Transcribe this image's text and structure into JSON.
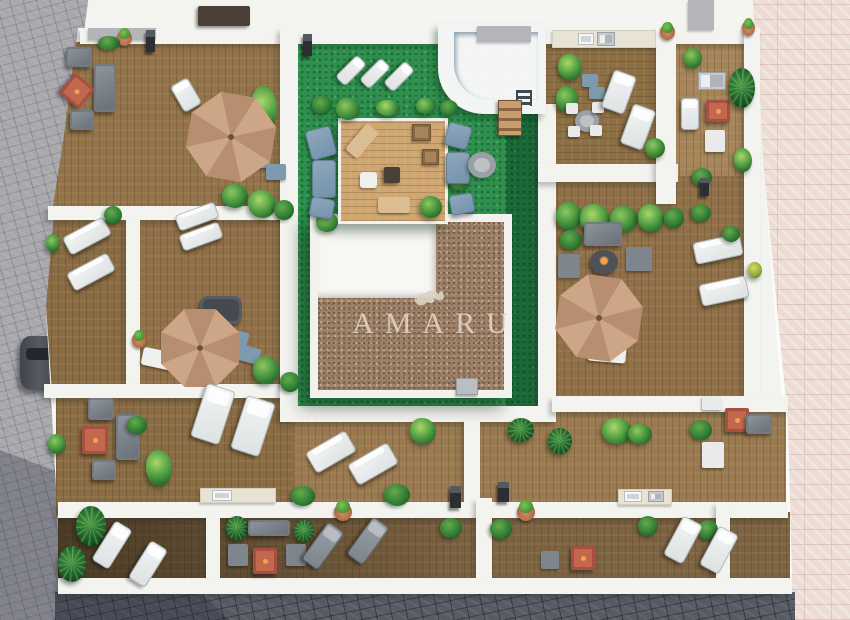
{
  "watermark": {
    "logo_icon": "amaru-monkey-logo-icon",
    "text": "AMARU"
  },
  "palette": {
    "street_white": "#f4f3f0",
    "wall_white": "#f3f3f0",
    "pavement_gray": "#a8a8ad",
    "pavement_dark": "#575b63",
    "pavement_pink": "#ecdcd4",
    "lawn_green": "#2e8f4e",
    "gravel_brown": "#9d8169",
    "pool_blue": "#7fc3e4",
    "umbrella_tan": "#c79f80",
    "fire_table_red": "#a8503f",
    "watermark_cream": "#ddd2c2"
  },
  "scene": {
    "items": [
      {
        "t": "car",
        "x": 20,
        "y": 336,
        "w": 42,
        "h": 54,
        "l": "under"
      },
      {
        "t": "table-dark",
        "x": 198,
        "y": 6,
        "w": 52,
        "h": 20
      },
      {
        "t": "gray-wall",
        "x": 88,
        "y": 28,
        "w": 68,
        "h": 12
      },
      {
        "t": "gray-wall",
        "x": 477,
        "y": 26,
        "w": 54,
        "h": 16
      },
      {
        "t": "gray-wall",
        "x": 688,
        "y": 0,
        "w": 26,
        "h": 30
      },
      {
        "t": "lamp",
        "x": 146,
        "y": 30,
        "w": 9,
        "h": 22
      },
      {
        "t": "lamp",
        "x": 303,
        "y": 34,
        "w": 9,
        "h": 22
      },
      {
        "t": "pot",
        "x": 117,
        "y": 30,
        "w": 15,
        "h": 16
      },
      {
        "t": "bush",
        "x": 98,
        "y": 36,
        "w": 22,
        "h": 14
      },
      {
        "t": "sofa-gray",
        "x": 66,
        "y": 47,
        "w": 26,
        "h": 20
      },
      {
        "t": "sofa-gray",
        "x": 94,
        "y": 64,
        "w": 22,
        "h": 48
      },
      {
        "t": "sofa-gray",
        "x": 70,
        "y": 110,
        "w": 24,
        "h": 20
      },
      {
        "t": "table-red",
        "x": 64,
        "y": 78,
        "w": 26,
        "h": 26,
        "r": 40
      },
      {
        "t": "lounger-white",
        "x": 176,
        "y": 80,
        "w": 20,
        "h": 30,
        "r": -30
      },
      {
        "t": "plant",
        "x": 251,
        "y": 86,
        "w": 26,
        "h": 44,
        "v": "leafy"
      },
      {
        "t": "chair-blue",
        "x": 250,
        "y": 152,
        "w": 20,
        "h": 16
      },
      {
        "t": "chair-blue",
        "x": 266,
        "y": 164,
        "w": 20,
        "h": 16
      },
      {
        "t": "umbrella",
        "x": 188,
        "y": 94,
        "w": 86,
        "h": 86,
        "r": 10
      },
      {
        "t": "lounger-white",
        "x": 344,
        "y": 55,
        "w": 14,
        "h": 31,
        "r": 45
      },
      {
        "t": "lounger-white",
        "x": 368,
        "y": 58,
        "w": 14,
        "h": 31,
        "r": 45
      },
      {
        "t": "lounger-white",
        "x": 392,
        "y": 61,
        "w": 14,
        "h": 31,
        "r": 45
      },
      {
        "t": "bush",
        "x": 312,
        "y": 96,
        "w": 20,
        "h": 18
      },
      {
        "t": "plant",
        "x": 336,
        "y": 98,
        "w": 24,
        "h": 22
      },
      {
        "t": "plant",
        "x": 376,
        "y": 100,
        "w": 24,
        "h": 16,
        "v": "leafy"
      },
      {
        "t": "plant",
        "x": 416,
        "y": 98,
        "w": 20,
        "h": 16
      },
      {
        "t": "bush",
        "x": 440,
        "y": 100,
        "w": 18,
        "h": 16
      },
      {
        "t": "plant",
        "x": 448,
        "y": 170,
        "w": 22,
        "h": 20,
        "v": "leafy"
      },
      {
        "t": "plant",
        "x": 316,
        "y": 212,
        "w": 22,
        "h": 20
      },
      {
        "t": "plant",
        "x": 420,
        "y": 196,
        "w": 22,
        "h": 22
      },
      {
        "t": "lounger-blue",
        "x": 308,
        "y": 128,
        "w": 26,
        "h": 30,
        "r": -15
      },
      {
        "t": "lounger-blue",
        "x": 312,
        "y": 160,
        "w": 24,
        "h": 38
      },
      {
        "t": "lounger-blue",
        "x": 310,
        "y": 198,
        "w": 24,
        "h": 20,
        "r": 10
      },
      {
        "t": "lounger-blue",
        "x": 446,
        "y": 124,
        "w": 24,
        "h": 24,
        "r": 15
      },
      {
        "t": "lounger-blue",
        "x": 446,
        "y": 152,
        "w": 24,
        "h": 32
      },
      {
        "t": "lounger-blue",
        "x": 450,
        "y": 194,
        "w": 24,
        "h": 20,
        "r": -10
      },
      {
        "t": "table-round-gray",
        "x": 468,
        "y": 152,
        "w": 28,
        "h": 26
      },
      {
        "t": "mat-tan",
        "x": 354,
        "y": 124,
        "w": 16,
        "h": 34,
        "r": 40
      },
      {
        "t": "table-wood",
        "x": 412,
        "y": 124,
        "w": 19,
        "h": 17
      },
      {
        "t": "table-wood",
        "x": 422,
        "y": 149,
        "w": 17,
        "h": 16
      },
      {
        "t": "table-dark",
        "x": 384,
        "y": 167,
        "w": 16,
        "h": 16
      },
      {
        "t": "mat-white",
        "x": 360,
        "y": 172,
        "w": 17,
        "h": 16
      },
      {
        "t": "mat-tan",
        "x": 378,
        "y": 197,
        "w": 32,
        "h": 16
      },
      {
        "t": "stairs",
        "x": 498,
        "y": 100,
        "w": 24,
        "h": 36
      },
      {
        "t": "counter",
        "x": 552,
        "y": 30,
        "w": 104,
        "h": 18
      },
      {
        "t": "sink",
        "x": 578,
        "y": 33,
        "w": 16,
        "h": 12
      },
      {
        "t": "appliance",
        "x": 597,
        "y": 32,
        "w": 18,
        "h": 14
      },
      {
        "t": "plant",
        "x": 558,
        "y": 54,
        "w": 24,
        "h": 26,
        "v": "leafy"
      },
      {
        "t": "plant",
        "x": 556,
        "y": 86,
        "w": 22,
        "h": 26
      },
      {
        "t": "chair-blue",
        "x": 582,
        "y": 74,
        "w": 16,
        "h": 13
      },
      {
        "t": "chair-blue",
        "x": 589,
        "y": 87,
        "w": 16,
        "h": 12
      },
      {
        "t": "table-round-gray",
        "x": 575,
        "y": 110,
        "w": 24,
        "h": 22
      },
      {
        "t": "chair-white",
        "x": 566,
        "y": 103,
        "w": 12,
        "h": 11
      },
      {
        "t": "chair-white",
        "x": 592,
        "y": 102,
        "w": 12,
        "h": 11
      },
      {
        "t": "chair-white",
        "x": 568,
        "y": 126,
        "w": 12,
        "h": 11
      },
      {
        "t": "chair-white",
        "x": 590,
        "y": 125,
        "w": 12,
        "h": 11
      },
      {
        "t": "lounger-white",
        "x": 607,
        "y": 72,
        "w": 24,
        "h": 40,
        "r": 20
      },
      {
        "t": "lounger-white",
        "x": 626,
        "y": 106,
        "w": 24,
        "h": 42,
        "r": 20
      },
      {
        "t": "plant",
        "x": 645,
        "y": 138,
        "w": 20,
        "h": 20
      },
      {
        "t": "pot",
        "x": 660,
        "y": 24,
        "w": 15,
        "h": 16
      },
      {
        "t": "appliance",
        "x": 698,
        "y": 72,
        "w": 28,
        "h": 18
      },
      {
        "t": "table-red",
        "x": 706,
        "y": 100,
        "w": 24,
        "h": 22
      },
      {
        "t": "chair-white",
        "x": 705,
        "y": 130,
        "w": 20,
        "h": 22
      },
      {
        "t": "lounger-white",
        "x": 681,
        "y": 98,
        "w": 18,
        "h": 32
      },
      {
        "t": "plant",
        "x": 684,
        "y": 48,
        "w": 18,
        "h": 20
      },
      {
        "t": "palm",
        "x": 729,
        "y": 68,
        "w": 26,
        "h": 40
      },
      {
        "t": "bush",
        "x": 692,
        "y": 168,
        "w": 20,
        "h": 18
      },
      {
        "t": "plant",
        "x": 734,
        "y": 148,
        "w": 18,
        "h": 24,
        "v": "leafy"
      },
      {
        "t": "pot",
        "x": 742,
        "y": 20,
        "w": 13,
        "h": 16
      },
      {
        "t": "lamp",
        "x": 700,
        "y": 178,
        "w": 9,
        "h": 18
      },
      {
        "t": "plant",
        "x": 556,
        "y": 202,
        "w": 26,
        "h": 28
      },
      {
        "t": "plant",
        "x": 580,
        "y": 204,
        "w": 30,
        "h": 30,
        "v": "leafy"
      },
      {
        "t": "plant",
        "x": 610,
        "y": 206,
        "w": 28,
        "h": 26
      },
      {
        "t": "plant",
        "x": 638,
        "y": 204,
        "w": 26,
        "h": 28,
        "v": "leafy"
      },
      {
        "t": "bush",
        "x": 560,
        "y": 230,
        "w": 22,
        "h": 20
      },
      {
        "t": "bush",
        "x": 664,
        "y": 208,
        "w": 20,
        "h": 20
      },
      {
        "t": "bush",
        "x": 691,
        "y": 204,
        "w": 20,
        "h": 18
      },
      {
        "t": "sofa-gray",
        "x": 584,
        "y": 222,
        "w": 38,
        "h": 24
      },
      {
        "t": "firepit-dark",
        "x": 590,
        "y": 250,
        "w": 28,
        "h": 24
      },
      {
        "t": "chair-gray",
        "x": 558,
        "y": 254,
        "w": 22,
        "h": 24
      },
      {
        "t": "chair-gray",
        "x": 626,
        "y": 247,
        "w": 26,
        "h": 24
      },
      {
        "t": "mat-white",
        "x": 588,
        "y": 344,
        "w": 38,
        "h": 18,
        "r": 5
      },
      {
        "t": "umbrella",
        "x": 557,
        "y": 276,
        "w": 84,
        "h": 84,
        "r": 8
      },
      {
        "t": "lounger-white",
        "x": 694,
        "y": 238,
        "w": 48,
        "h": 22,
        "r": -12
      },
      {
        "t": "lounger-white",
        "x": 700,
        "y": 280,
        "w": 48,
        "h": 22,
        "r": -12
      },
      {
        "t": "plant",
        "x": 748,
        "y": 262,
        "w": 14,
        "h": 16,
        "v": "yellow"
      },
      {
        "t": "bush",
        "x": 722,
        "y": 226,
        "w": 18,
        "h": 16
      },
      {
        "t": "lounger-white",
        "x": 176,
        "y": 208,
        "w": 42,
        "h": 17,
        "r": -20
      },
      {
        "t": "lounger-white",
        "x": 180,
        "y": 228,
        "w": 42,
        "h": 17,
        "r": -20
      },
      {
        "t": "plant",
        "x": 222,
        "y": 184,
        "w": 26,
        "h": 24
      },
      {
        "t": "plant",
        "x": 248,
        "y": 190,
        "w": 28,
        "h": 28,
        "v": "leafy"
      },
      {
        "t": "bush",
        "x": 274,
        "y": 200,
        "w": 20,
        "h": 20
      },
      {
        "t": "hot-tub",
        "x": 200,
        "y": 296,
        "w": 42,
        "h": 28
      },
      {
        "t": "chair-blue",
        "x": 222,
        "y": 330,
        "w": 26,
        "h": 16,
        "r": 15
      },
      {
        "t": "chair-blue",
        "x": 234,
        "y": 346,
        "w": 26,
        "h": 16,
        "r": 15
      },
      {
        "t": "mat-white",
        "x": 142,
        "y": 350,
        "w": 34,
        "h": 18,
        "r": 12
      },
      {
        "t": "pot",
        "x": 132,
        "y": 332,
        "w": 14,
        "h": 16
      },
      {
        "t": "plant",
        "x": 253,
        "y": 356,
        "w": 26,
        "h": 28
      },
      {
        "t": "bush",
        "x": 280,
        "y": 372,
        "w": 20,
        "h": 20
      },
      {
        "t": "umbrella",
        "x": 161,
        "y": 309,
        "w": 78,
        "h": 78
      },
      {
        "t": "lounger-white",
        "x": 64,
        "y": 226,
        "w": 46,
        "h": 20,
        "r": -28
      },
      {
        "t": "lounger-white",
        "x": 68,
        "y": 262,
        "w": 46,
        "h": 20,
        "r": -28
      },
      {
        "t": "bush",
        "x": 104,
        "y": 206,
        "w": 18,
        "h": 18
      },
      {
        "t": "plant",
        "x": 46,
        "y": 234,
        "w": 14,
        "h": 18
      },
      {
        "t": "sofa-gray",
        "x": 88,
        "y": 398,
        "w": 26,
        "h": 22
      },
      {
        "t": "sofa-gray",
        "x": 116,
        "y": 414,
        "w": 24,
        "h": 46
      },
      {
        "t": "sofa-gray",
        "x": 92,
        "y": 460,
        "w": 24,
        "h": 20
      },
      {
        "t": "table-red",
        "x": 82,
        "y": 426,
        "w": 26,
        "h": 28
      },
      {
        "t": "plant",
        "x": 146,
        "y": 450,
        "w": 26,
        "h": 36,
        "v": "leafy"
      },
      {
        "t": "bush",
        "x": 127,
        "y": 416,
        "w": 20,
        "h": 18
      },
      {
        "t": "plant",
        "x": 48,
        "y": 434,
        "w": 18,
        "h": 20
      },
      {
        "t": "lounger-white",
        "x": 198,
        "y": 386,
        "w": 30,
        "h": 56,
        "r": 18
      },
      {
        "t": "lounger-white",
        "x": 238,
        "y": 398,
        "w": 30,
        "h": 56,
        "r": 18
      },
      {
        "t": "counter",
        "x": 200,
        "y": 488,
        "w": 76,
        "h": 15
      },
      {
        "t": "sink",
        "x": 212,
        "y": 490,
        "w": 20,
        "h": 11
      },
      {
        "t": "lounger-white",
        "x": 308,
        "y": 440,
        "w": 46,
        "h": 24,
        "r": -30
      },
      {
        "t": "lounger-white",
        "x": 350,
        "y": 452,
        "w": 46,
        "h": 24,
        "r": -30
      },
      {
        "t": "plant",
        "x": 410,
        "y": 418,
        "w": 26,
        "h": 26,
        "v": "leafy"
      },
      {
        "t": "bush",
        "x": 384,
        "y": 484,
        "w": 26,
        "h": 22
      },
      {
        "t": "bush",
        "x": 291,
        "y": 486,
        "w": 24,
        "h": 20
      },
      {
        "t": "lamp",
        "x": 450,
        "y": 486,
        "w": 11,
        "h": 22
      },
      {
        "t": "lamp",
        "x": 498,
        "y": 482,
        "w": 11,
        "h": 20
      },
      {
        "t": "pot",
        "x": 334,
        "y": 503,
        "w": 18,
        "h": 18
      },
      {
        "t": "pot",
        "x": 517,
        "y": 503,
        "w": 18,
        "h": 18
      },
      {
        "t": "palm",
        "x": 508,
        "y": 418,
        "w": 26,
        "h": 24
      },
      {
        "t": "palm",
        "x": 548,
        "y": 428,
        "w": 24,
        "h": 26
      },
      {
        "t": "plant",
        "x": 602,
        "y": 418,
        "w": 30,
        "h": 26,
        "v": "leafy"
      },
      {
        "t": "plant",
        "x": 628,
        "y": 424,
        "w": 24,
        "h": 20
      },
      {
        "t": "bush",
        "x": 690,
        "y": 420,
        "w": 22,
        "h": 20
      },
      {
        "t": "chair-white",
        "x": 702,
        "y": 396,
        "w": 20,
        "h": 14
      },
      {
        "t": "chair-white",
        "x": 702,
        "y": 442,
        "w": 22,
        "h": 26
      },
      {
        "t": "table-red",
        "x": 725,
        "y": 408,
        "w": 24,
        "h": 24
      },
      {
        "t": "sofa-gray",
        "x": 746,
        "y": 414,
        "w": 26,
        "h": 20
      },
      {
        "t": "counter",
        "x": 618,
        "y": 489,
        "w": 54,
        "h": 16
      },
      {
        "t": "sink",
        "x": 624,
        "y": 491,
        "w": 18,
        "h": 11
      },
      {
        "t": "appliance",
        "x": 648,
        "y": 491,
        "w": 16,
        "h": 11
      },
      {
        "t": "palm",
        "x": 76,
        "y": 506,
        "w": 30,
        "h": 40
      },
      {
        "t": "palm",
        "x": 58,
        "y": 546,
        "w": 28,
        "h": 36
      },
      {
        "t": "lounger-white",
        "x": 102,
        "y": 522,
        "w": 20,
        "h": 46,
        "r": 32
      },
      {
        "t": "lounger-white",
        "x": 138,
        "y": 542,
        "w": 20,
        "h": 44,
        "r": 32
      },
      {
        "t": "palm",
        "x": 226,
        "y": 516,
        "w": 22,
        "h": 24
      },
      {
        "t": "sofa-gray",
        "x": 248,
        "y": 520,
        "w": 42,
        "h": 16
      },
      {
        "t": "palm",
        "x": 294,
        "y": 520,
        "w": 20,
        "h": 22
      },
      {
        "t": "chair-gray",
        "x": 228,
        "y": 544,
        "w": 20,
        "h": 22
      },
      {
        "t": "chair-gray",
        "x": 286,
        "y": 544,
        "w": 20,
        "h": 22
      },
      {
        "t": "table-red",
        "x": 253,
        "y": 548,
        "w": 24,
        "h": 26
      },
      {
        "t": "lounger-gray",
        "x": 313,
        "y": 523,
        "w": 20,
        "h": 46,
        "r": 36
      },
      {
        "t": "lounger-gray",
        "x": 358,
        "y": 518,
        "w": 20,
        "h": 46,
        "r": 36
      },
      {
        "t": "bush",
        "x": 440,
        "y": 518,
        "w": 22,
        "h": 20
      },
      {
        "t": "bush",
        "x": 490,
        "y": 519,
        "w": 22,
        "h": 20
      },
      {
        "t": "chair-gray",
        "x": 541,
        "y": 551,
        "w": 18,
        "h": 18
      },
      {
        "t": "table-red",
        "x": 571,
        "y": 546,
        "w": 24,
        "h": 24
      },
      {
        "t": "bush",
        "x": 638,
        "y": 516,
        "w": 20,
        "h": 20
      },
      {
        "t": "bush",
        "x": 698,
        "y": 520,
        "w": 20,
        "h": 20
      },
      {
        "t": "lounger-white",
        "x": 672,
        "y": 518,
        "w": 22,
        "h": 44,
        "r": 28
      },
      {
        "t": "lounger-white",
        "x": 708,
        "y": 528,
        "w": 22,
        "h": 44,
        "r": 28
      },
      {
        "t": "ac-box",
        "x": 456,
        "y": 378,
        "w": 22,
        "h": 17
      }
    ]
  }
}
